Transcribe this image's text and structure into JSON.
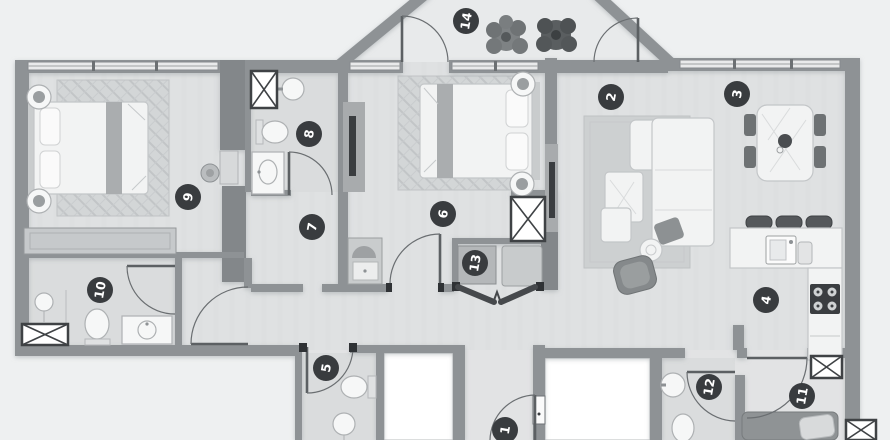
{
  "plan": {
    "type": "apartment-floor-plan",
    "markers": [
      {
        "label": "1"
      },
      {
        "label": "2"
      },
      {
        "label": "3"
      },
      {
        "label": "4"
      },
      {
        "label": "5"
      },
      {
        "label": "6"
      },
      {
        "label": "7"
      },
      {
        "label": "8"
      },
      {
        "label": "9"
      },
      {
        "label": "10"
      },
      {
        "label": "11"
      },
      {
        "label": "12"
      },
      {
        "label": "13"
      },
      {
        "label": "14"
      }
    ],
    "colors": {
      "background": "#eef0f1",
      "floor": "#dfe1e2",
      "wall": "#8e9295",
      "marker_bg": "#393c3f",
      "marker_text": "#ffffff",
      "accent_dark": "#3a3d40",
      "furniture_light": "#f2f3f3"
    }
  }
}
